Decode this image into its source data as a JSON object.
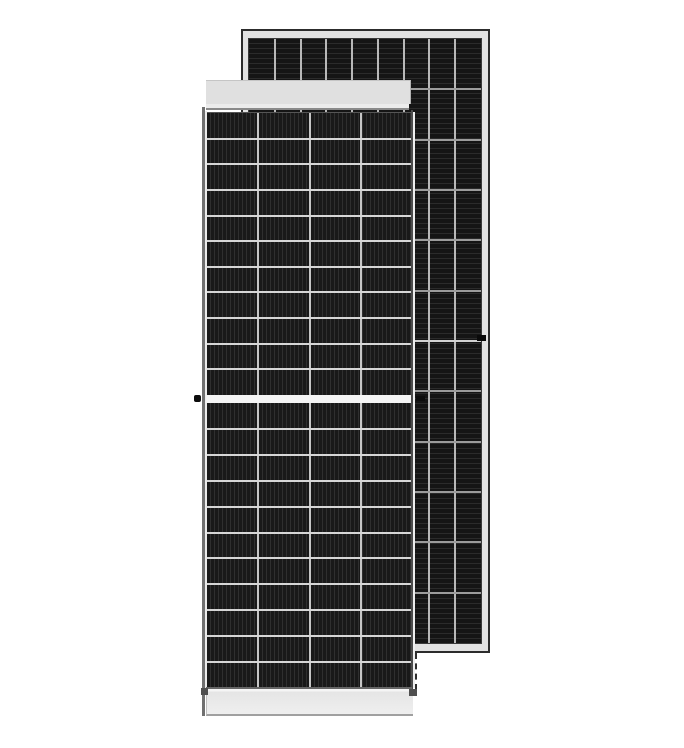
{
  "image": {
    "type": "product-photo",
    "subject": "Two framed half-cut-cell monocrystalline solar panel modules, front view overlapping rear view",
    "background_color": "#ffffff"
  },
  "rear_panel": {
    "label": "rear-view-solar-panel",
    "frame_color": "#e2e2e2",
    "frame_edge_color": "#2c2c2c",
    "grounding_hole_color": "#0a0a0a",
    "face": {
      "columns": 9,
      "rows": 12,
      "cell_color": "#151515",
      "stripe_highlight": "#2b2b2b",
      "stripe_angle": "0deg",
      "stripe_width": 4,
      "column_divider_color": "#b8b8b8",
      "row_divider_color": "#9c9c9c",
      "center_divider_color": "#d2d2d2"
    }
  },
  "front_panel": {
    "label": "front-view-solar-panel",
    "top_rail_color": "#e0e0e0",
    "top_rail_step_color": "#ececec",
    "left_frame_edge_color": "#707070",
    "left_frame_inner_color": "#ebebeb",
    "right_frame_edge_color": "#4c4c4c",
    "right_frame_outer_color": "#eeeeee",
    "center_gap_color": "#f4f4f4",
    "bottom_edge_color": "#666666",
    "bottom_rail_gradient_top": "#f5f5f5",
    "bottom_rail_color": "#e5e5e5",
    "corner_notch_color": "#4f4f4f",
    "grounding_lug_color": "#0d0d0d",
    "face_upper": {
      "columns": 4,
      "rows": 11,
      "cell_color": "#191919",
      "stripe_highlight": "#2f2f2f",
      "stripe_angle": "90deg",
      "stripe_width": 3,
      "column_divider_color": "#c6c6c6",
      "row_divider_color": "#d6d6d6"
    },
    "face_lower": {
      "columns": 4,
      "rows": 11,
      "cell_color": "#191919",
      "stripe_highlight": "#2f2f2f",
      "stripe_angle": "90deg",
      "stripe_width": 3,
      "column_divider_color": "#c6c6c6",
      "row_divider_color": "#d6d6d6"
    }
  }
}
